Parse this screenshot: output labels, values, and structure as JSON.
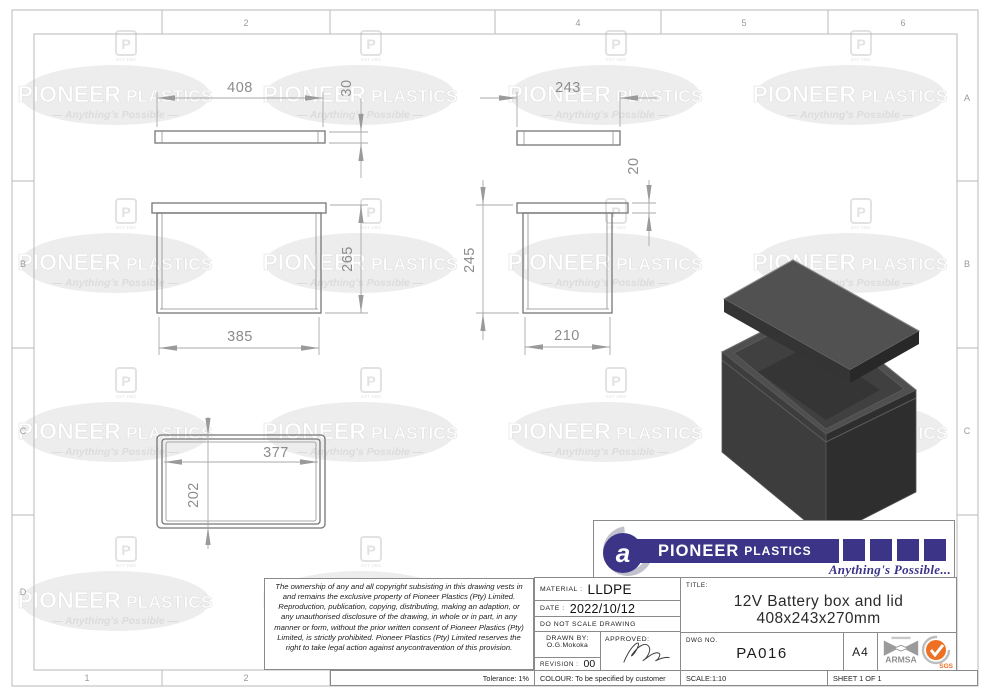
{
  "grid": {
    "top": [
      "",
      "2",
      "",
      "4",
      "5",
      "6"
    ],
    "bottom": [
      "1",
      "2"
    ],
    "left": [
      "",
      "B",
      "C",
      "D"
    ],
    "right": [
      "A",
      "B",
      "C",
      ""
    ]
  },
  "watermark": {
    "brand1": "PIONEER",
    "brand2": "PLASTICS",
    "tagline": "Anything's Possible",
    "emblem_letter": "P",
    "emblem_sub": "EST 1982"
  },
  "dims": {
    "lid_width": "408",
    "lid_height": "30",
    "lid_depth": "243",
    "lip_height": "20",
    "box_front_height": "265",
    "box_front_width": "385",
    "box_side_height": "245",
    "box_side_width": "210",
    "plan_width": "377",
    "plan_depth": "202"
  },
  "logo": {
    "brand1": "PIONEER",
    "brand2": "PLASTICS",
    "tagline": "Anything's Possible...",
    "navy": "#3b3487"
  },
  "title_block": {
    "copyright": "The ownership of any and all copyright subsisting in this drawing vests in and remains the exclusive property of Pioneer Plastics (Pty) Limited. Reproduction, publication, copying, distributing, making an adaption, or any unauthorised disclosure of the drawing, in whole or in part, in any manner or form, without the prior written consent of Pioneer Plastics (Pty) Limited, is strictly prohibited. Pioneer Plastics (Pty) Limited reserves the right to take legal action against anycontravention of this provision.",
    "tolerance": "Tolerance: 1%",
    "material_label": "MATERIAL :",
    "material_value": "LLDPE",
    "date_label": "DATE :",
    "date_value": "2022/10/12",
    "no_scale": "DO NOT SCALE DRAWING",
    "drawn_label": "DRAWN BY:",
    "drawn_value": "O.G.Mokoka",
    "approved_label": "APPROVED:",
    "revision_label": "REVISION :",
    "revision_value": "00",
    "colour": "COLOUR: To be specified by customer",
    "title_label": "TITLE:",
    "title_line1": "12V Battery box and lid",
    "title_line2": "408x243x270mm",
    "dwg_label": "DWG NO.",
    "dwg_value": "PA016",
    "paper_size": "A4",
    "scale": "SCALE:1:10",
    "sheet": "SHEET 1 OF 1",
    "armsa": "ARMSA",
    "sgs": "SGS"
  }
}
